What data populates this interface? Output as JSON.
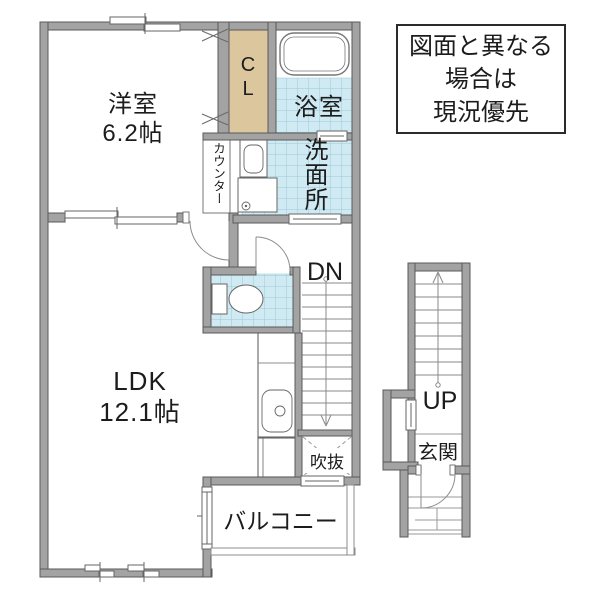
{
  "disclaimer": {
    "lines": [
      "図面と異なる",
      "場合は",
      "現況優先"
    ]
  },
  "labels": {
    "western_room_name": "洋室",
    "western_room_size": "6.2帖",
    "ldk_name": "LDK",
    "ldk_size": "12.1帖",
    "bathroom": "浴室",
    "washroom": "洗面所",
    "closet": "CL",
    "counter": "カウンター",
    "stairs_down": "DN",
    "stairs_up": "UP",
    "void": "吹抜",
    "balcony": "バルコニー",
    "entrance": "玄関"
  },
  "colors": {
    "wall": "#a3a3a3",
    "wall-border": "#5a5a5a",
    "tile": "#cfeaf2",
    "tile-grid": "#9cc8d6",
    "closet-fill": "#dbc69e",
    "fixture-line": "#666666",
    "thin-line": "#8a8a8a",
    "text": "#1c1c1c"
  }
}
